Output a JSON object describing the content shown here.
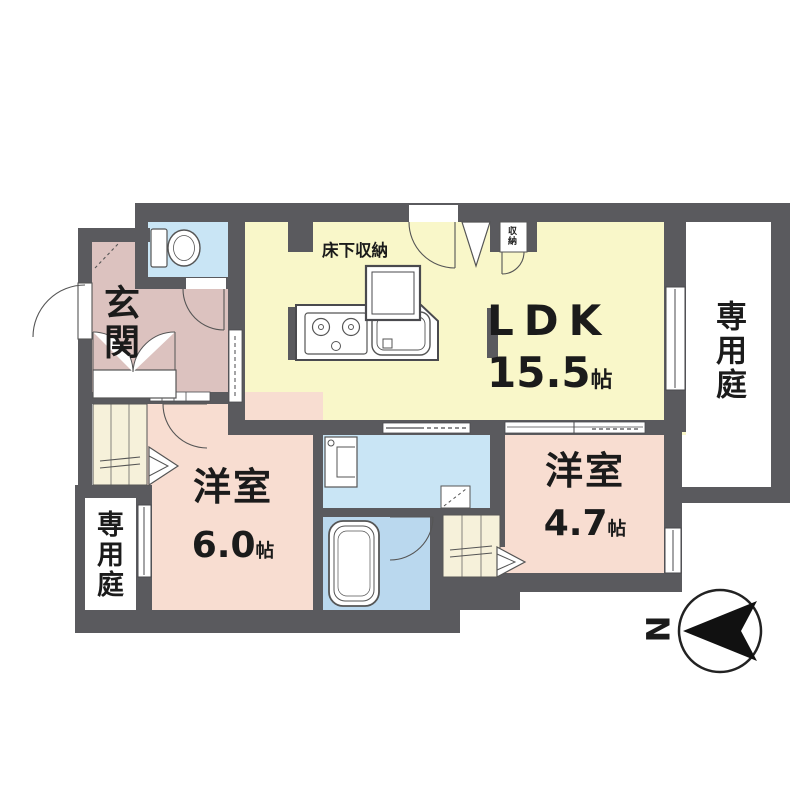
{
  "rooms": {
    "ldk": {
      "name": "LDK",
      "area_value": "15.5",
      "area_unit": "帖"
    },
    "bedroom_west": {
      "name": "洋室",
      "area_value": "6.0",
      "area_unit": "帖"
    },
    "bedroom_east": {
      "name": "洋室",
      "area_value": "4.7",
      "area_unit": "帖"
    },
    "entrance": {
      "name": "玄関"
    },
    "garden_east": {
      "name": "専用庭"
    },
    "garden_west": {
      "name": "専用庭"
    }
  },
  "storage": {
    "floor_storage_label": "床下収納",
    "closet_label": "収納"
  },
  "compass": {
    "north_label": "N"
  },
  "colors": {
    "wall": "#5a5a5e",
    "ldk_floor": "#f9f7c9",
    "bedroom_floor": "#f8ddd1",
    "entrance_floor": "#dcc2bf",
    "washroom_floor": "#c9e5f5",
    "bathroom_floor": "#bad8ee",
    "closet_floor": "#f6f1da",
    "line": "#4a4a4e",
    "text": "#1b1b1b"
  }
}
